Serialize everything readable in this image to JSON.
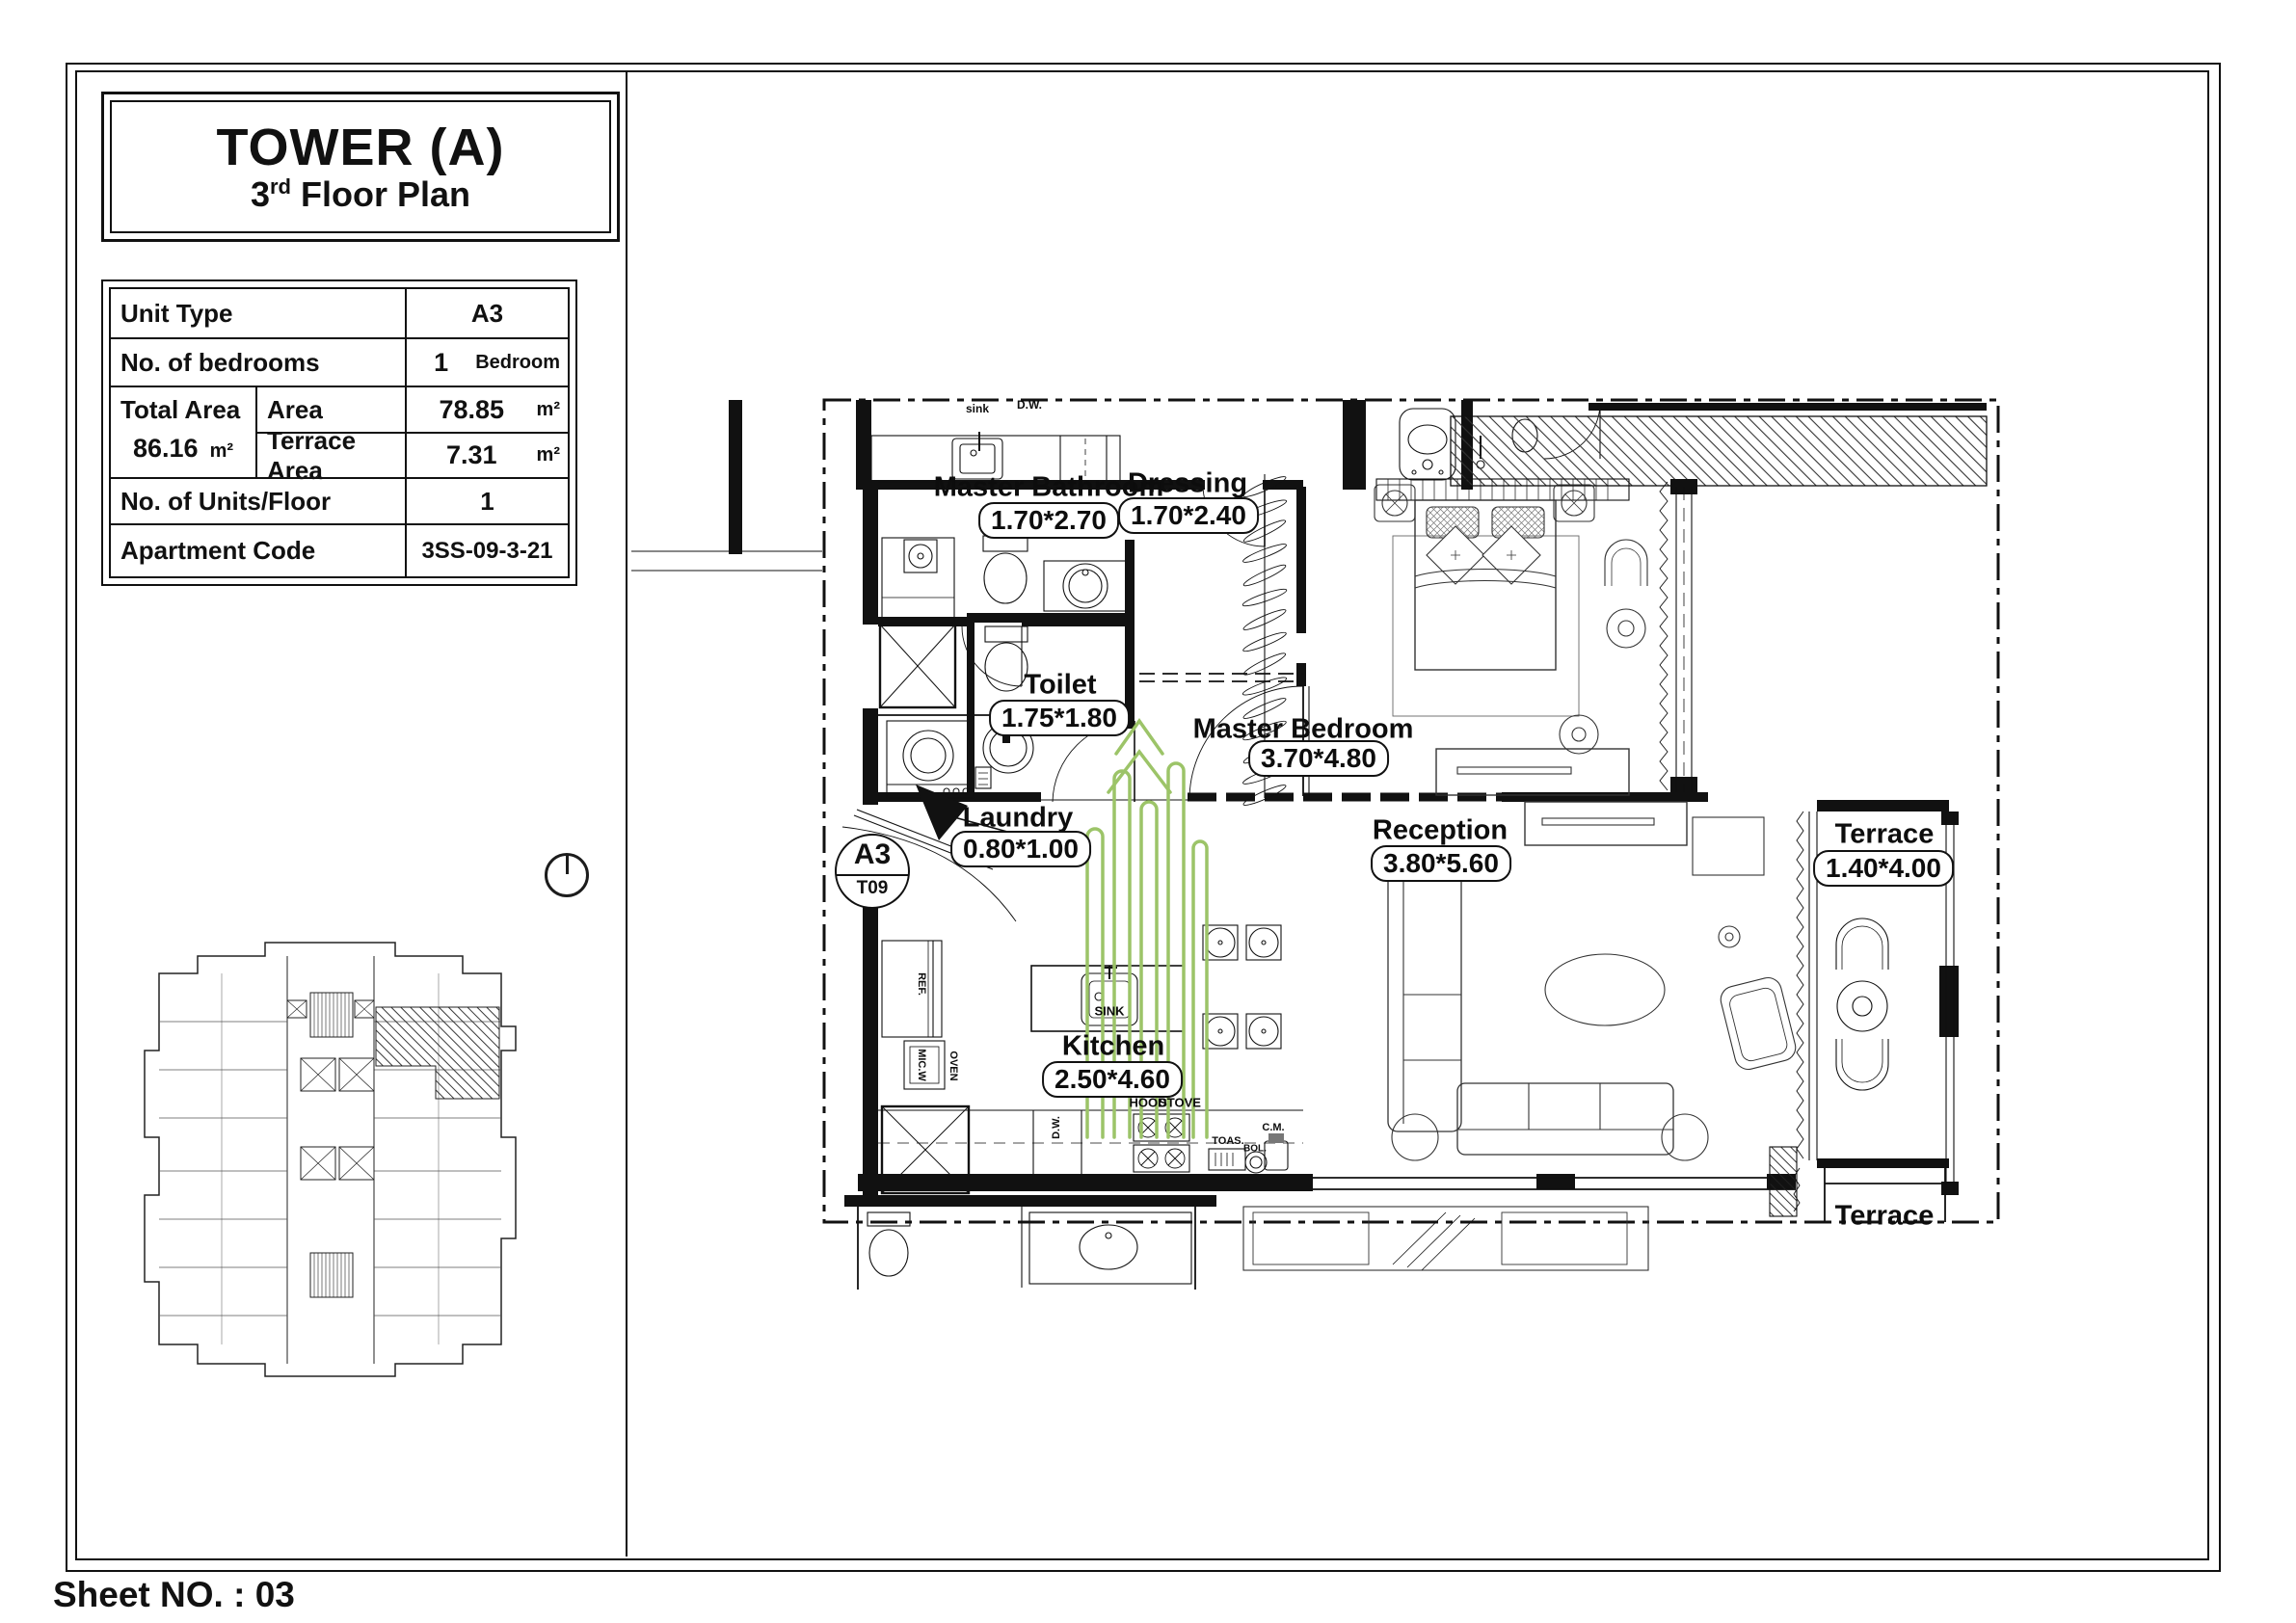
{
  "sheet": {
    "label": "Sheet NO. : 03"
  },
  "title_block": {
    "title": "TOWER (A)",
    "floor_number": "3",
    "floor_ordinal": "rd",
    "floor_text": "Floor Plan"
  },
  "info_table": {
    "unit_type_label": "Unit Type",
    "unit_type_value": "A3",
    "bedrooms_label": "No. of bedrooms",
    "bedrooms_value": "1",
    "bedrooms_unit": "Bedroom",
    "total_area_label": "Total Area",
    "total_area_value": "86.16",
    "total_area_unit": "m²",
    "area_label": "Area",
    "area_value": "78.85",
    "area_unit": "m²",
    "terrace_area_label": "Terrace Area",
    "terrace_area_value": "7.31",
    "terrace_area_unit": "m²",
    "units_floor_label": "No. of Units/Floor",
    "units_floor_value": "1",
    "apartment_code_label": "Apartment Code",
    "apartment_code_value": "3SS-09-3-21"
  },
  "unit_marker": {
    "unit": "A3",
    "tower": "T09"
  },
  "rooms": [
    {
      "name": "Master Bathroom",
      "dims": "1.70*2.70"
    },
    {
      "name": "Dressing",
      "dims": "1.70*2.40"
    },
    {
      "name": "Toilet",
      "dims": "1.75*1.80"
    },
    {
      "name": "Master Bedroom",
      "dims": "3.70*4.80"
    },
    {
      "name": "Laundry",
      "dims": "0.80*1.00"
    },
    {
      "name": "Reception",
      "dims": "3.80*5.60"
    },
    {
      "name": "Kitchen",
      "dims": "2.50*4.60"
    },
    {
      "name": "Terrace",
      "dims": "1.40*4.00"
    },
    {
      "name": "Terrace",
      "dims": ""
    }
  ],
  "fixtures": {
    "sink_small": "sink",
    "dw_top": "D.W.",
    "island_sink": "SINK",
    "hood": "HOOD",
    "stove": "STOVE",
    "toaster": "TOAS.",
    "boiler": "BOL.",
    "coffee_maker": "C.M.",
    "dishwasher": "D.W.",
    "refrigerator": "REF.",
    "microwave": "MIC.W",
    "oven": "OVEN"
  },
  "colors": {
    "ink": "#111111",
    "plant_green": "#9cc468"
  }
}
